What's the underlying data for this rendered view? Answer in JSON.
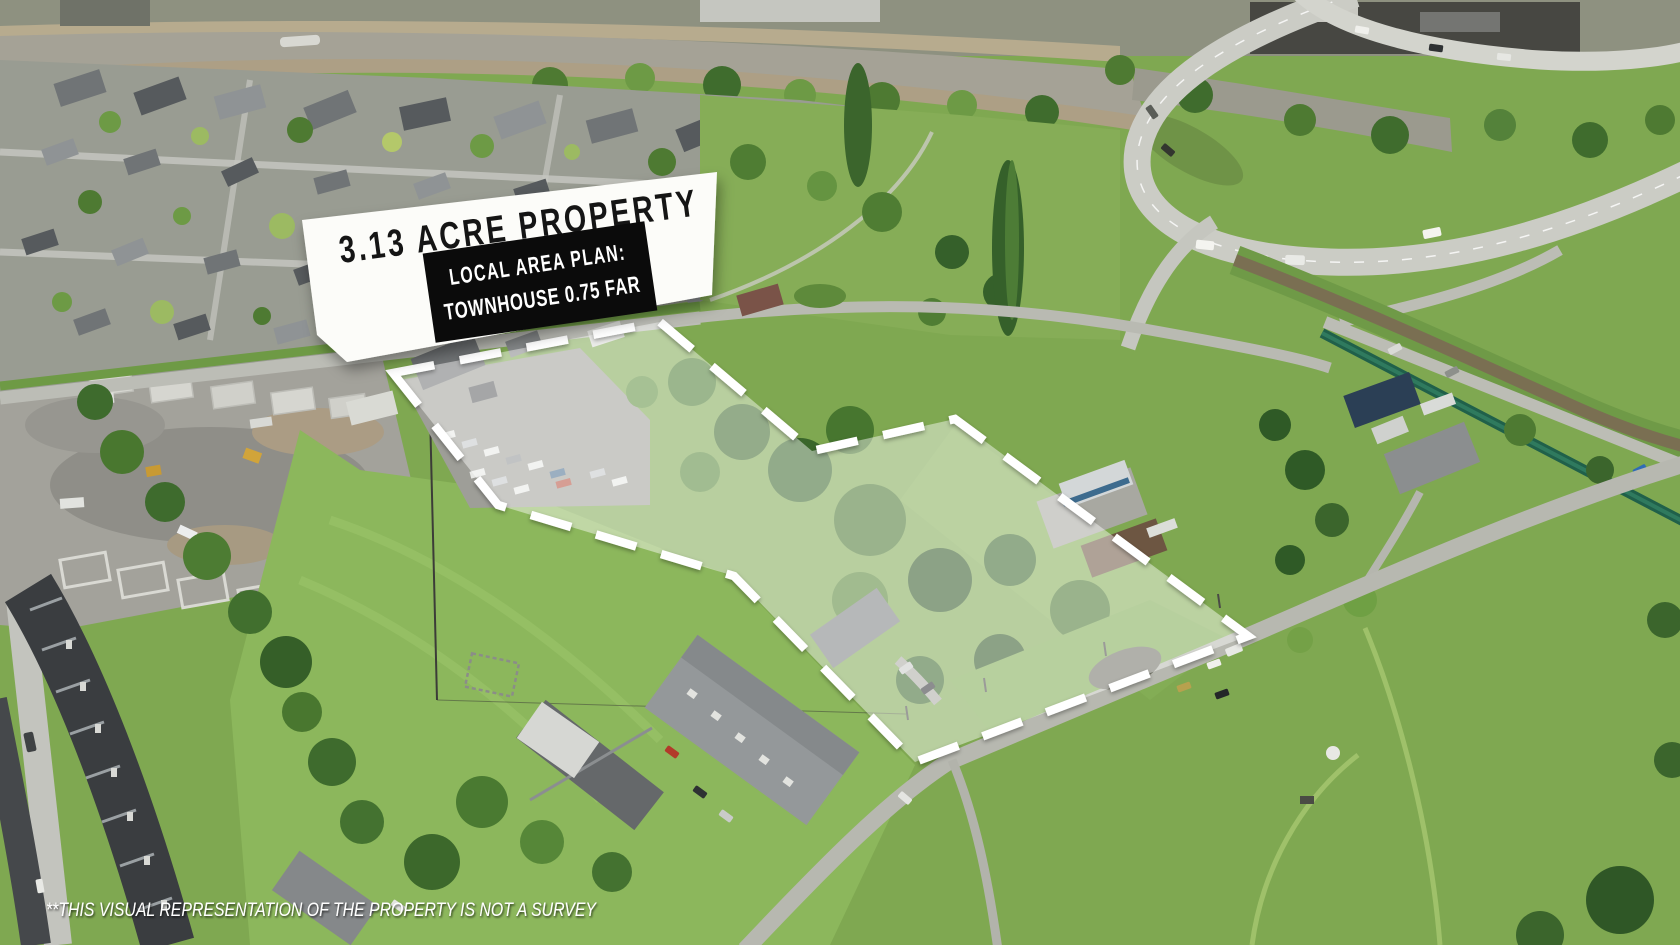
{
  "page": {
    "title": "Aerial property marketing image"
  },
  "sign": {
    "title": "3.13 ACRE PROPERTY",
    "plan_label": "LOCAL AREA PLAN:",
    "plan_value": "TOWNHOUSE 0.75 FAR",
    "panel_color": "#fcfcf9",
    "plan_box_color": "#0b0b0b",
    "title_color": "#151515",
    "plan_text_color": "#ffffff"
  },
  "property": {
    "outline_points": "393,373 660,322 812,451 955,419 1248,636 915,762 734,576 498,505",
    "overlay_fill": "rgba(255,255,255,0.45)",
    "boundary_color": "#ffffff",
    "boundary_width": "8.5",
    "boundary_dash": "42 26"
  },
  "disclaimer": {
    "text": "**THIS VISUAL REPRESENTATION OF THE PROPERTY IS NOT A SURVEY",
    "color": "#ffffff"
  }
}
